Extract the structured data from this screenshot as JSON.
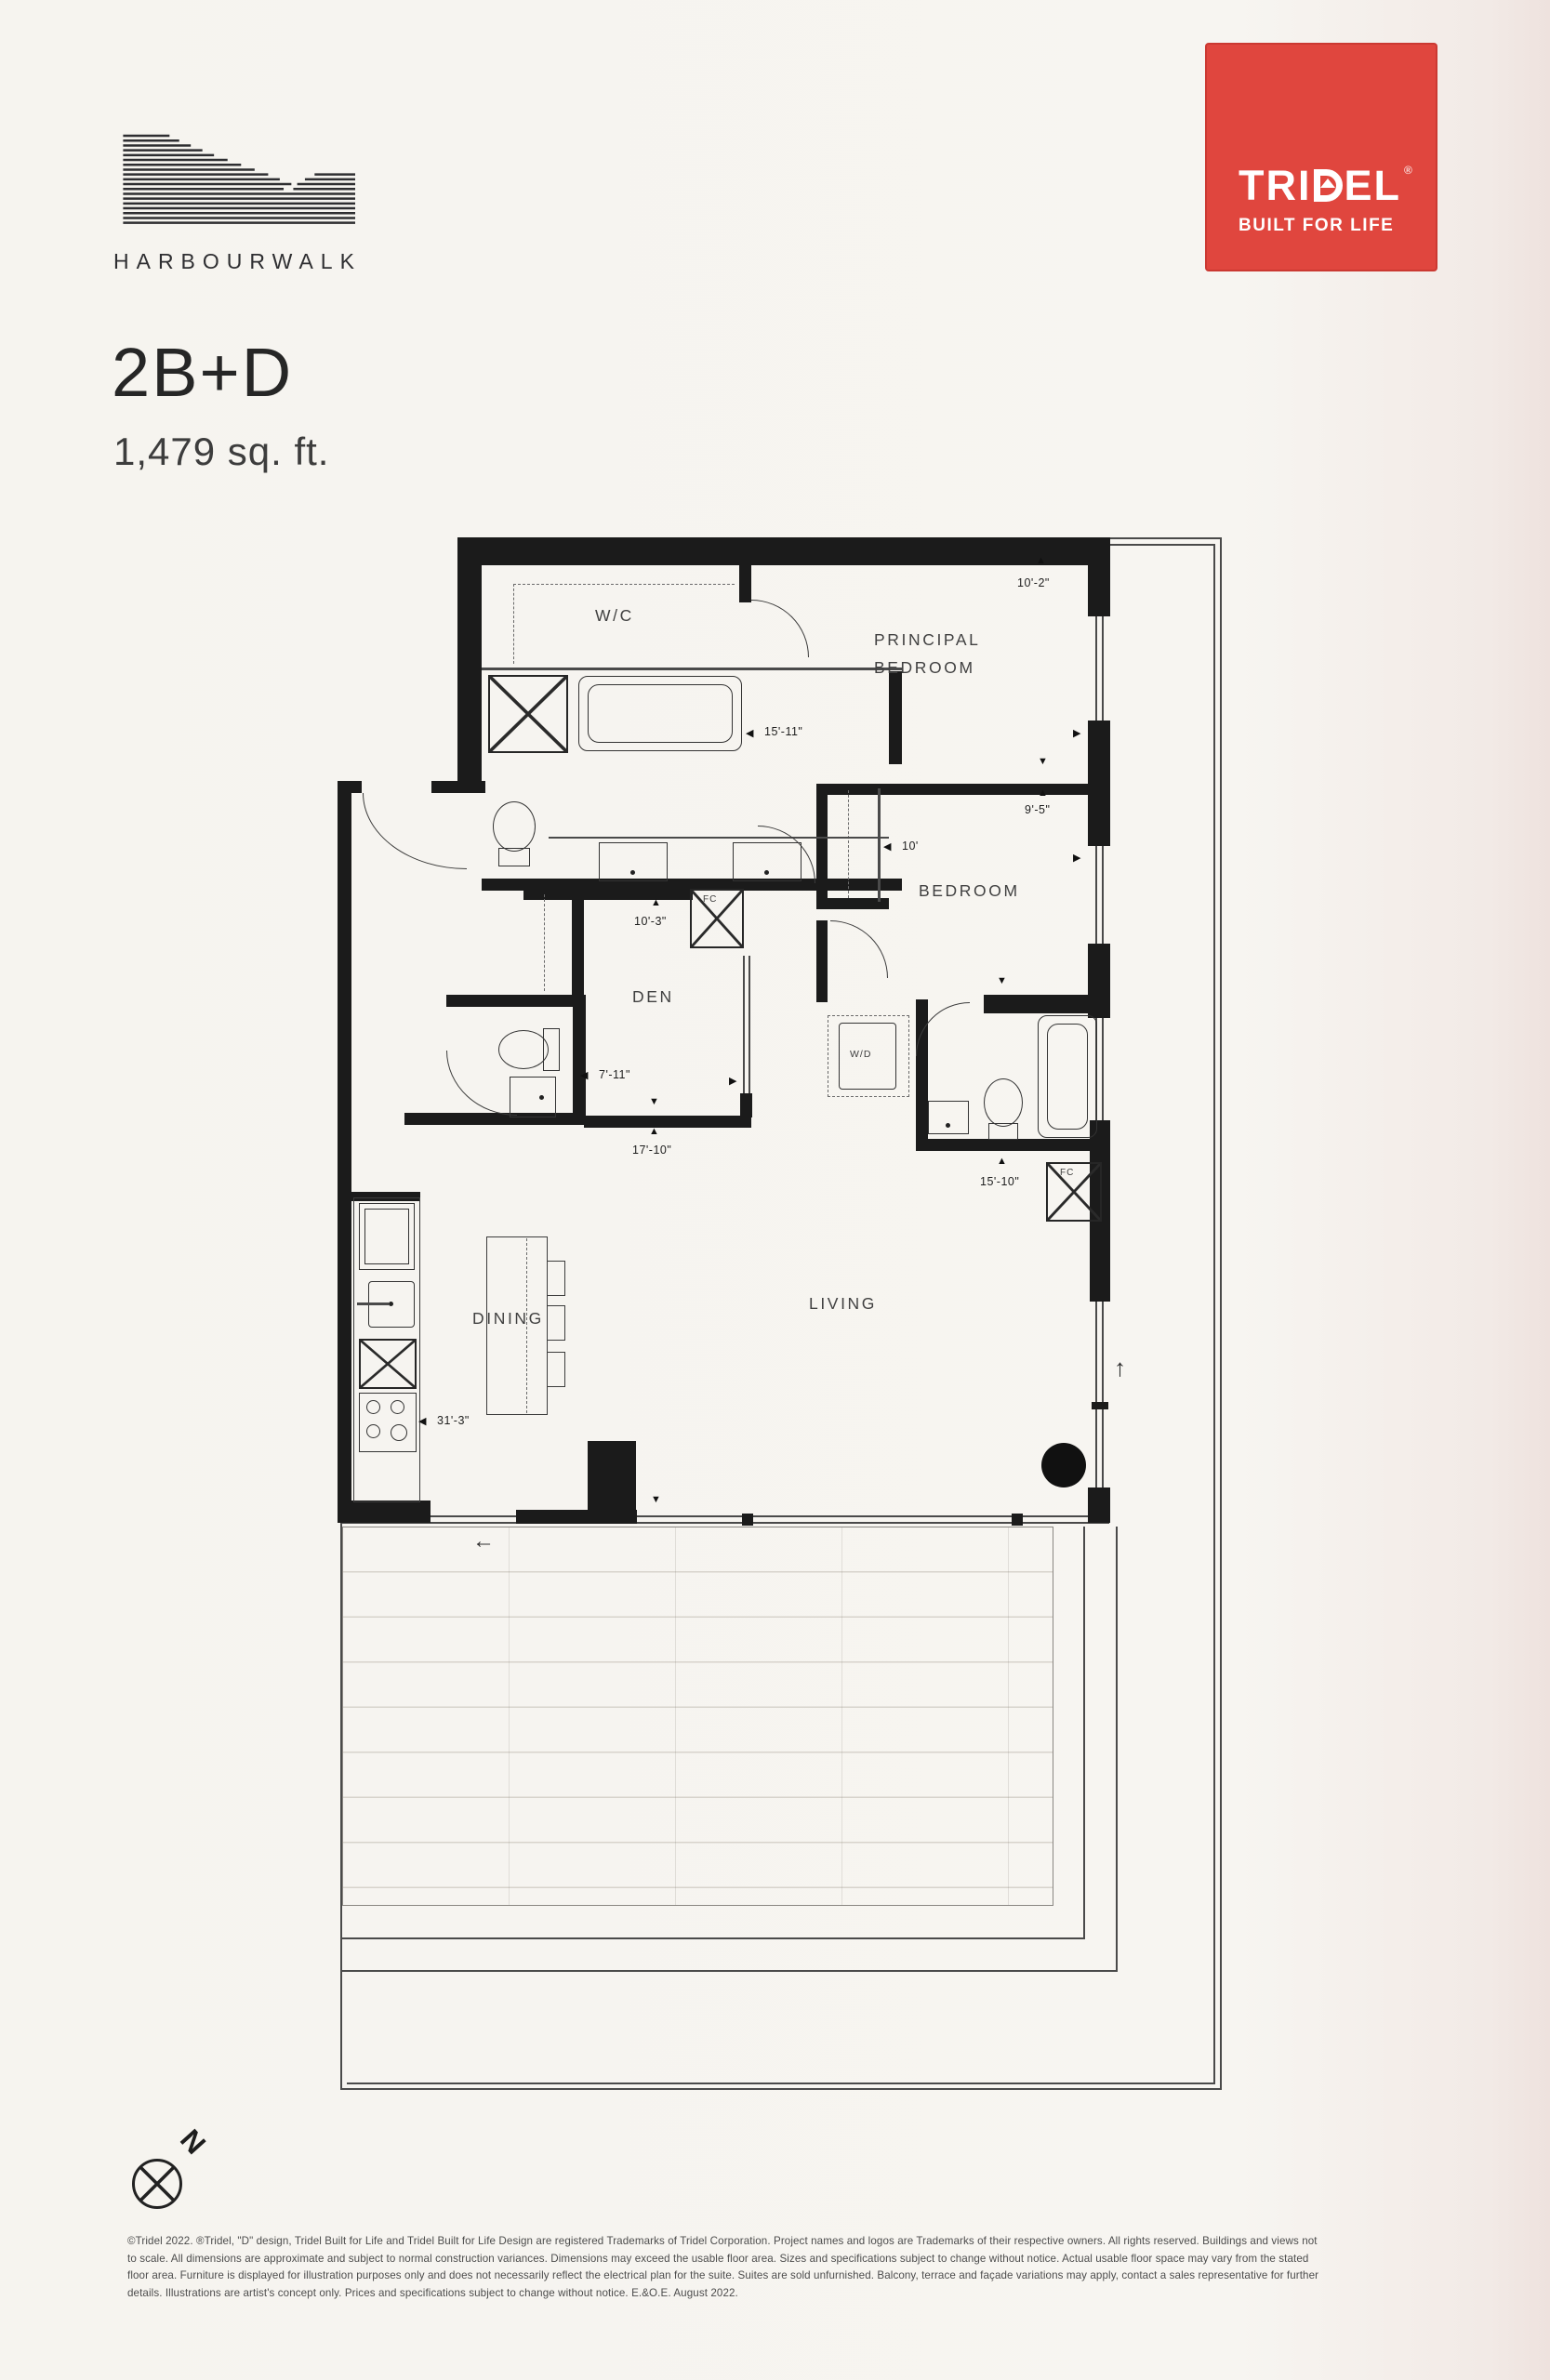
{
  "header": {
    "brand": "HARBOURWALK",
    "badge": {
      "pre": "TRI",
      "post": "EL",
      "reg": "®",
      "tagline": "BUILT FOR LIFE",
      "color": "#e0463e"
    }
  },
  "title": {
    "plan": "2B+D",
    "area": "1,479 sq. ft."
  },
  "rooms": {
    "wc": "W/C",
    "principal1": "PRINCIPAL",
    "principal2": "BEDROOM",
    "bedroom": "BEDROOM",
    "den": "DEN",
    "dining": "DINING",
    "living": "LIVING",
    "wd": "W/D",
    "fc_a": "FC",
    "fc_b": "FC"
  },
  "dims": {
    "principal_width": "10'-2\"",
    "ensuite_width": "15'-11\"",
    "bedroom_depth": "9'-5\"",
    "bedroom_closet": "10'",
    "den_width": "10'-3\"",
    "den_depth": "7'-11\"",
    "den_overall": "17'-10\"",
    "living_width": "15'-10\"",
    "suite_length": "31'-3\""
  },
  "icons": {
    "arrow_up": "▲",
    "arrow_down": "▼",
    "arrow_left": "◀",
    "arrow_right": "▶",
    "slide_left": "←",
    "slide_up": "↑"
  },
  "compass": {
    "north": "N"
  },
  "legal": {
    "line1": "©Tridel 2022. ®Tridel, \"D\" design, Tridel Built for Life and Tridel Built for Life Design are registered Trademarks of Tridel Corporation. Project names and logos are Trademarks of their respective owners. All rights reserved. Buildings and views not",
    "line2": "to scale. All dimensions are approximate and subject to normal construction variances. Dimensions may exceed the usable floor area. Sizes and specifications subject to change without notice. Actual usable floor space may vary from the stated",
    "line3": "floor area. Furniture is displayed for illustration purposes only and does not necessarily reflect the electrical plan for the suite. Suites are sold unfurnished. Balcony, terrace and façade variations may apply, contact a sales representative for further",
    "line4": "details. Illustrations are artist's concept only. Prices and specifications subject to change without notice. E.&O.E. August 2022."
  }
}
